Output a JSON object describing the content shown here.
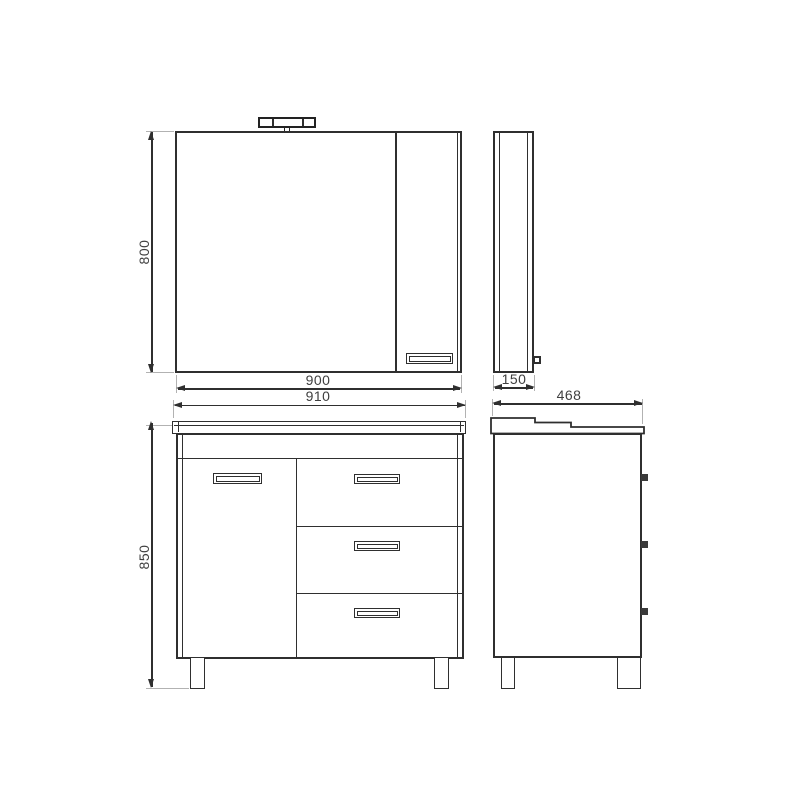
{
  "dimensions": {
    "mirror_height": "800",
    "mirror_width": "900",
    "mirror_depth": "150",
    "vanity_width": "910",
    "vanity_height": "850",
    "vanity_depth": "468"
  },
  "colors": {
    "line": "#2f2f2f",
    "extension_line": "#b2b2b2",
    "text": "#3f3f3f",
    "background": "#ffffff"
  }
}
